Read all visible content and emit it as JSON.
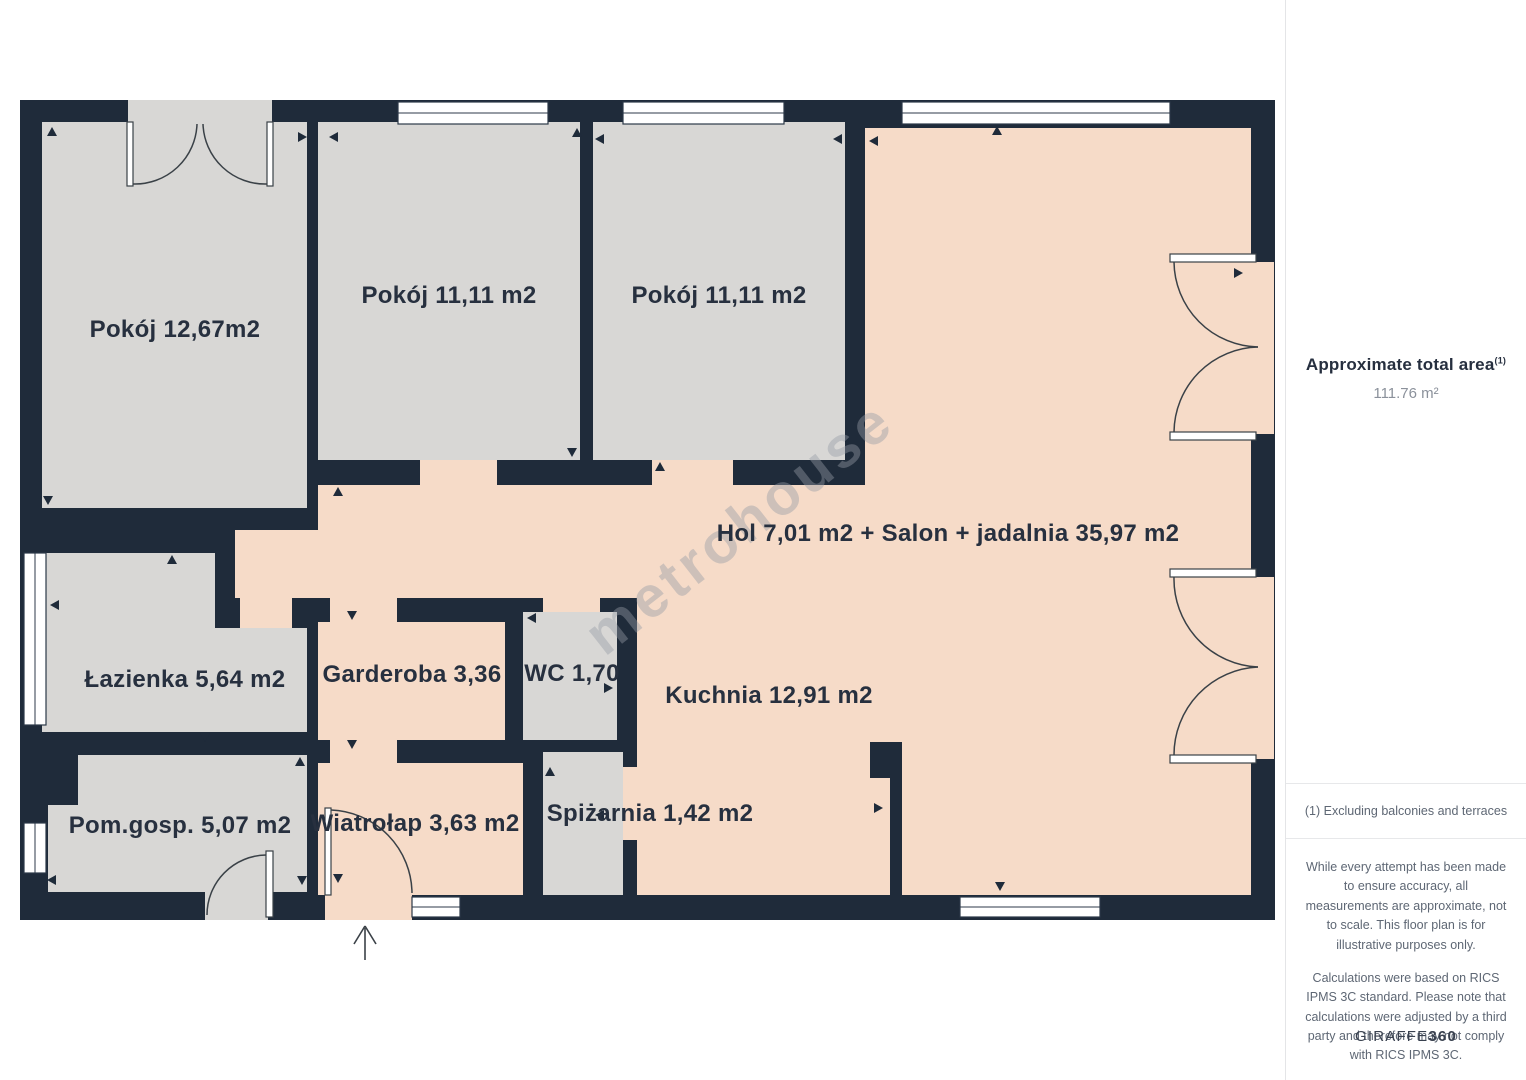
{
  "floorplan": {
    "watermark": "metrohouse",
    "colors": {
      "wall": "#1f2b3a",
      "room_gray": "#d8d7d5",
      "room_pink": "#f6dbc8",
      "label": "#27303f",
      "watermark": "#969ca6"
    },
    "rooms": [
      {
        "id": "pokoj-1",
        "label": "Pokój 12,67m2"
      },
      {
        "id": "pokoj-2",
        "label": "Pokój 11,11 m2"
      },
      {
        "id": "pokoj-3",
        "label": "Pokój 11,11 m2"
      },
      {
        "id": "hol-salon",
        "label": "Hol 7,01 m2 + Salon + jadalnia 35,97 m2"
      },
      {
        "id": "lazienka",
        "label": "Łazienka 5,64 m2"
      },
      {
        "id": "garderoba",
        "label": "Garderoba 3,36"
      },
      {
        "id": "wc",
        "label": "WC 1,70"
      },
      {
        "id": "kuchnia",
        "label": "Kuchnia 12,91 m2"
      },
      {
        "id": "pom-gosp",
        "label": "Pom.gosp. 5,07 m2"
      },
      {
        "id": "wiatrolap",
        "label": "Wiatrołap 3,63 m2"
      },
      {
        "id": "spizarnia",
        "label": "Spiżarnia 1,42 m2"
      }
    ]
  },
  "sidebar": {
    "title": "Approximate total area",
    "title_superscript": "(1)",
    "total_area": "111.76 m²",
    "footnote": "(1) Excluding balconies and terraces",
    "disclaimer_1": "While every attempt has been made to ensure accuracy, all measurements are approximate, not to scale. This floor plan is for illustrative purposes only.",
    "disclaimer_2": "Calculations were based on RICS IPMS 3C standard. Please note that calculations were adjusted by a third party and therefore may not comply with RICS IPMS 3C.",
    "brand_name": "GIRAFFE",
    "brand_suffix": "360"
  }
}
